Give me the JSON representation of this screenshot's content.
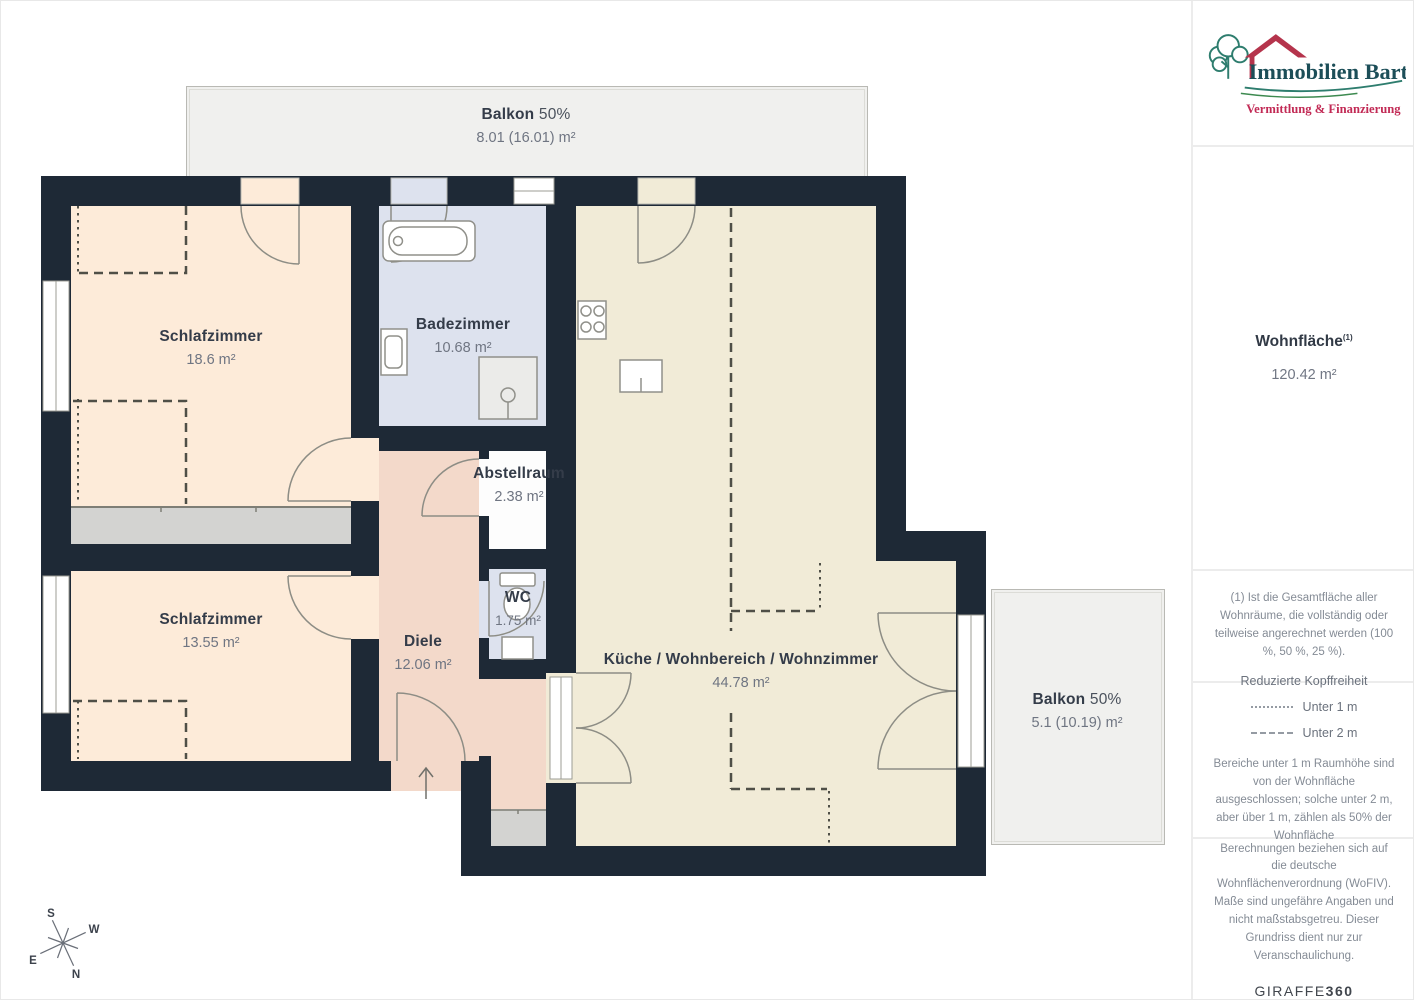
{
  "palette": {
    "wall": "#1e2936",
    "bedroom_fill": "#fdebd9",
    "bath_fill": "#dde2ee",
    "kitchen_fill": "#f1ebd7",
    "hall_fill": "#f3d9ca",
    "storage_fill": "#fdfdfd",
    "balcony_fill": "#f0f0ee",
    "closet_fill": "#d3d3d1",
    "reduced_height_line": "#4f4f47",
    "logo_teal": "#1c4e58",
    "logo_green": "#2e7d6e",
    "logo_red": "#bb2d57"
  },
  "floorplan": {
    "rooms": [
      {
        "name": "Balkon",
        "suffix": "50%",
        "area": "8.01 (16.01) m²"
      },
      {
        "name": "Schlafzimmer",
        "area": "18.6 m²"
      },
      {
        "name": "Badezimmer",
        "area": "10.68 m²"
      },
      {
        "name": "Abstellraum",
        "area": "2.38 m²"
      },
      {
        "name": "Schlafzimmer",
        "area": "13.55 m²"
      },
      {
        "name": "WC",
        "area": "1.75 m²"
      },
      {
        "name": "Diele",
        "area": "12.06 m²"
      },
      {
        "name": "Küche / Wohnbereich / Wohnzimmer",
        "area": "44.78 m²"
      },
      {
        "name": "Balkon",
        "suffix": "50%",
        "area": "5.1 (10.19) m²"
      }
    ],
    "compass": {
      "n": "N",
      "e": "E",
      "s": "S",
      "w": "W"
    }
  },
  "sidebar": {
    "logo": {
      "title": "Immobilien Bart",
      "subtitle": "Vermittlung & Finanzierung"
    },
    "summary": {
      "label": "Wohnfläche",
      "footnote_marker": "(1)",
      "value": "120.42 m²"
    },
    "footnote": "(1) Ist die Gesamtfläche aller Wohnräume, die vollständig oder teilweise angerechnet werden (100 %, 50 %, 25 %).",
    "legend": {
      "title": "Reduzierte Kopffreiheit",
      "items": [
        {
          "style": "dotted",
          "label": "Unter 1 m"
        },
        {
          "style": "dashed",
          "label": "Unter 2 m"
        }
      ],
      "note": "Bereiche unter 1 m Raumhöhe sind von der Wohnfläche ausgeschlossen; solche unter 2 m, aber über 1 m, zählen als 50% der Wohnfläche"
    },
    "disclaimer": "Berechnungen beziehen sich auf die deutsche Wohnflächenverordnung (WoFIV). Maße sind ungefähre Angaben und nicht maßstabsgetreu. Dieser Grundriss dient nur zur Veranschaulichung.",
    "brand": {
      "name": "GIRAFFE",
      "suffix": "360"
    }
  }
}
